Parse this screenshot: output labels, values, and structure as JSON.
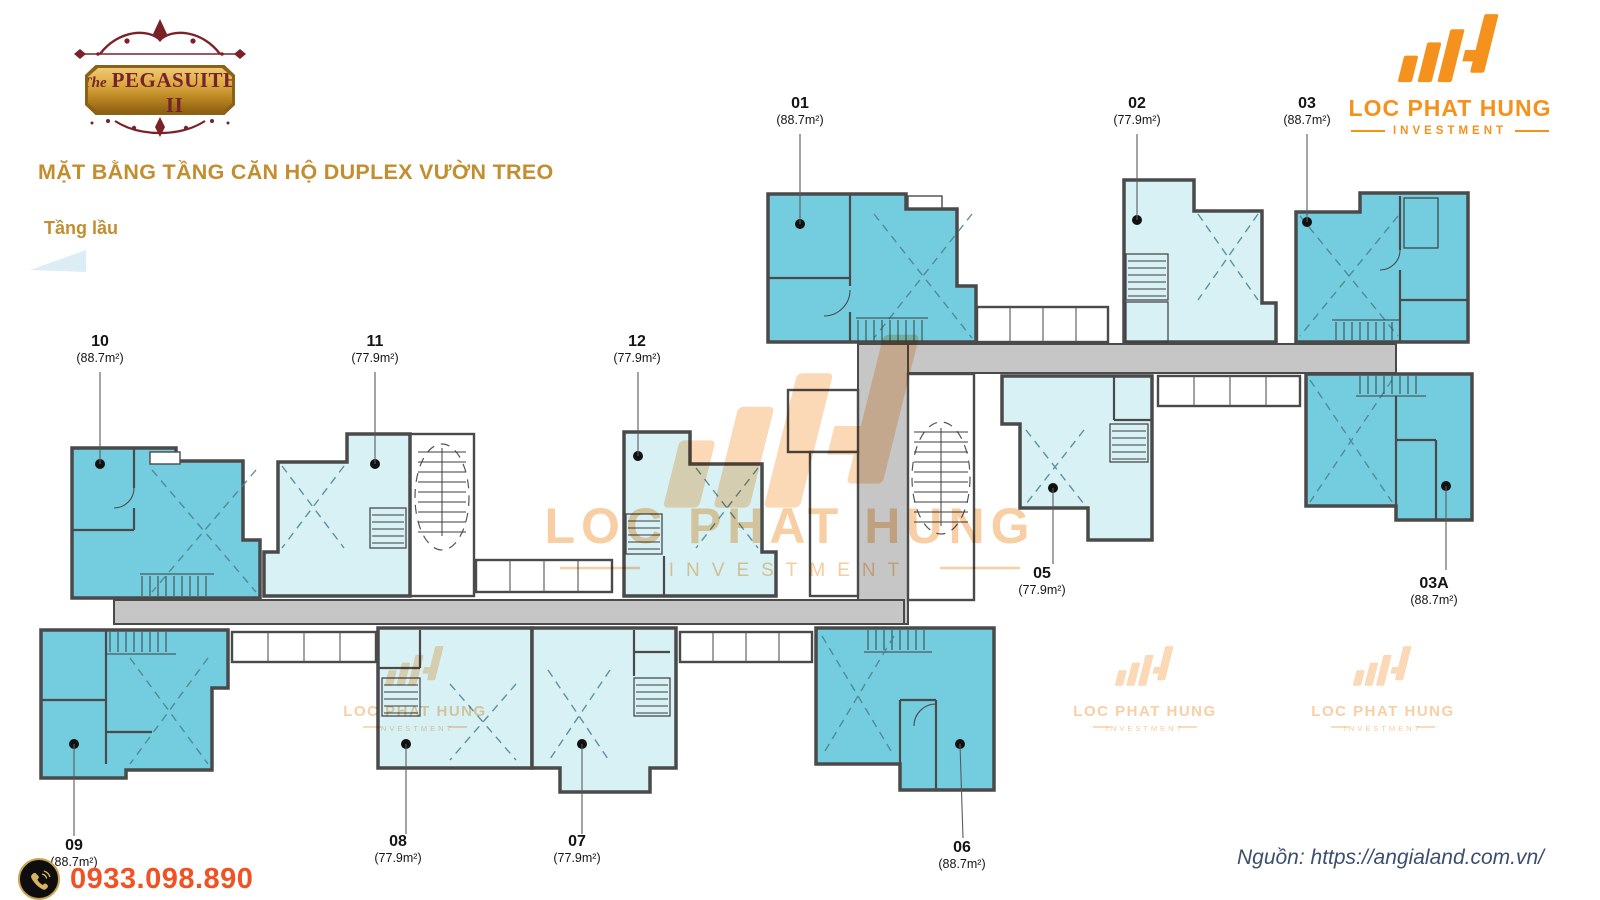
{
  "branding": {
    "plaque": {
      "the": "The",
      "name": "PEGASUITE II"
    },
    "company": {
      "name": "LOC PHAT HUNG",
      "division": "INVESTMENT"
    },
    "watermark": {
      "name": "LOC PHAT HUNG",
      "division": "INVESTMENT"
    }
  },
  "header": {
    "title": "MẶT BẰNG TẦNG CĂN HỘ DUPLEX VƯỜN TREO",
    "subtitle": "Tầng lầu"
  },
  "units": [
    {
      "id": "01",
      "number": "01",
      "area": "(88.7m²)"
    },
    {
      "id": "02",
      "number": "02",
      "area": "(77.9m²)"
    },
    {
      "id": "03",
      "number": "03",
      "area": "(88.7m²)"
    },
    {
      "id": "10",
      "number": "10",
      "area": "(88.7m²)"
    },
    {
      "id": "11",
      "number": "11",
      "area": "(77.9m²)"
    },
    {
      "id": "12",
      "number": "12",
      "area": "(77.9m²)"
    },
    {
      "id": "05",
      "number": "05",
      "area": "(77.9m²)"
    },
    {
      "id": "03A",
      "number": "03A",
      "area": "(88.7m²)"
    },
    {
      "id": "09",
      "number": "09",
      "area": "(88.7m²)"
    },
    {
      "id": "08",
      "number": "08",
      "area": "(77.9m²)"
    },
    {
      "id": "07",
      "number": "07",
      "area": "(77.9m²)"
    },
    {
      "id": "06",
      "number": "06",
      "area": "(88.7m²)"
    }
  ],
  "contact": {
    "icon": "phone-icon",
    "phone": "0933.098.890"
  },
  "source": {
    "text": "Nguồn: https://angialand.com.vn/"
  },
  "colors": {
    "accent_gold": "#C28E2F",
    "brand_orange": "#F5921E",
    "plaque_maroon": "#76232A",
    "phone_red": "#F05224",
    "source_navy": "#3D4E6E",
    "unit_fill_large": "#73CDDE",
    "unit_fill_small": "#D8F1F5",
    "corridor_gray": "#C6C6C6",
    "wall_gray": "#4A4A4A"
  }
}
